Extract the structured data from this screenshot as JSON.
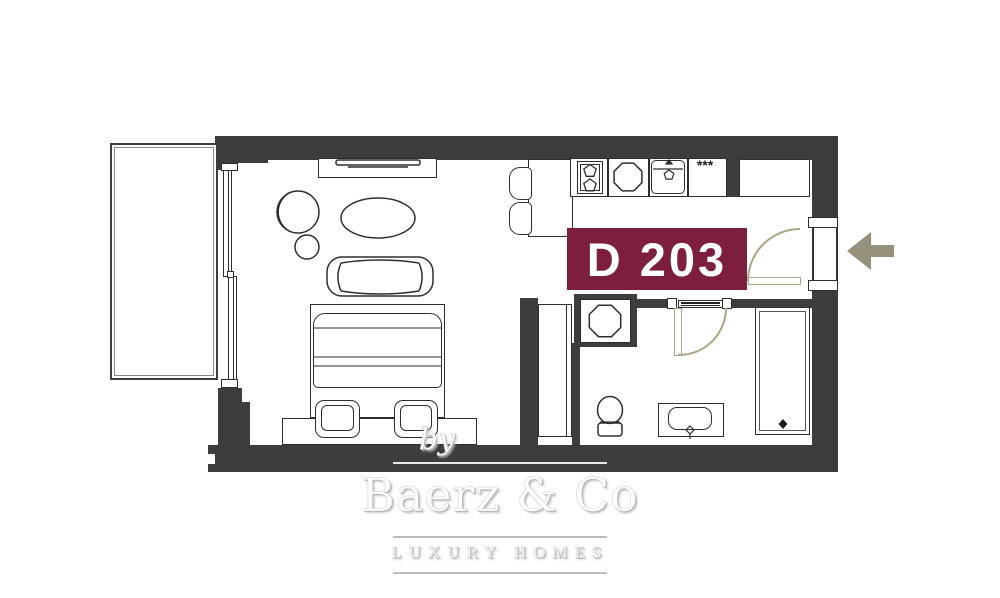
{
  "page": {
    "title": "Apartment floor plan"
  },
  "unit": {
    "label": "D 203",
    "label_bg": "#7d1e3d",
    "label_color": "#ffffff"
  },
  "kitchen": {
    "vent_symbol": "***"
  },
  "entrance": {
    "arrow_icon": "arrow-left",
    "arrow_color": "#95917c"
  },
  "branding": {
    "by": "by",
    "name": "Baerz & Co",
    "tagline": "LUXURY HOMES"
  },
  "palette": {
    "wall": "#3d3d3f",
    "outline": "#2e2e2e",
    "door_swing": "#aca588",
    "watermark_line": "#bdbdbd",
    "window_line": "#e0e0e0"
  },
  "fixtures": [
    "balcony",
    "sliding-glass-door",
    "tv-console",
    "armchair",
    "side-table",
    "coffee-table",
    "sofa",
    "double-bed",
    "ottoman",
    "ottoman",
    "bench",
    "bar-counter",
    "bar-stool",
    "bar-stool",
    "cooktop",
    "round-sink",
    "square-sink",
    "refrigerator-cabinet",
    "washing-machine",
    "wardrobe",
    "toilet",
    "washbasin",
    "shower",
    "entry-door",
    "bathroom-door"
  ]
}
